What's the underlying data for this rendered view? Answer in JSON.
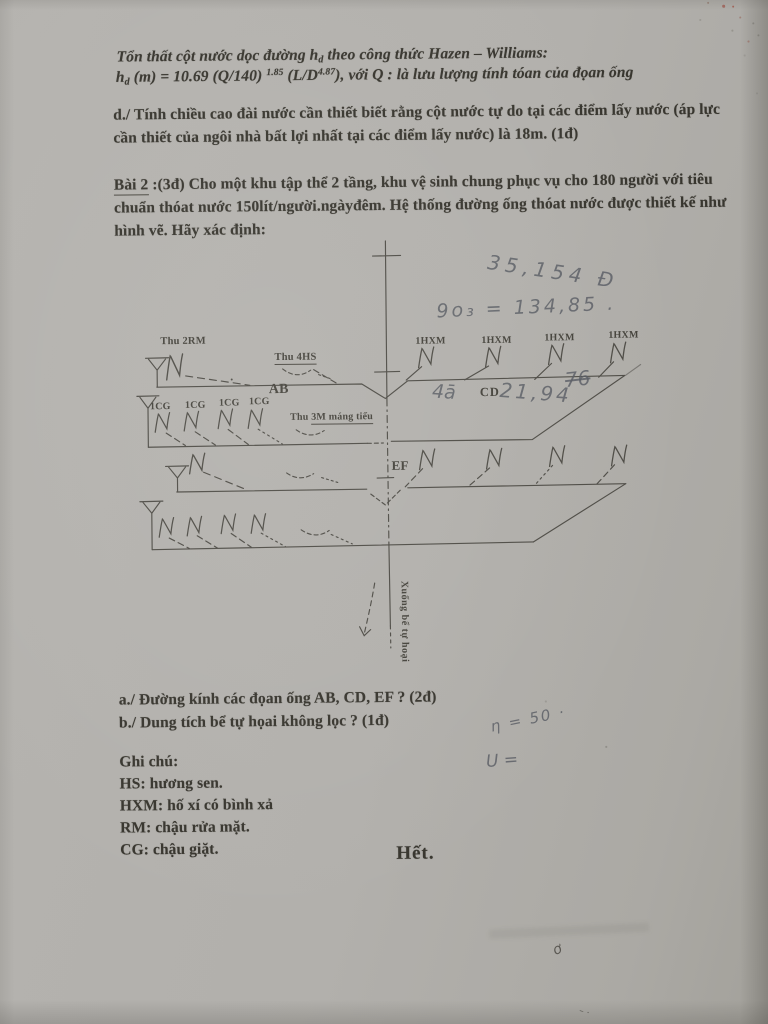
{
  "header": {
    "line1_pre": "Tổn thất cột nước dọc đường h",
    "line1_sub": "d",
    "line1_post": " theo công thức Hazen – Williams:",
    "formula_h": "h",
    "formula_sub": "d",
    "formula_mid1": " (m) =  10.69 (Q/140) ",
    "formula_exp1": "1.85",
    "formula_mid2": " (L/D",
    "formula_exp2": "4.87",
    "formula_post": "), với Q : là lưu lượng tính tóan của đọan ống"
  },
  "question_d": {
    "line1": "d./ Tính chiều cao đài nước cần thiết biết rằng cột nước tự do tại các điểm lấy nước (áp lực",
    "line2": "cần thiết của ngôi nhà bất lợi nhất tại các điểm lấy nước) là 18m. (1đ)"
  },
  "bai2": {
    "label": "Bài 2",
    "line1_rest": " :(3đ) Cho một khu tập thể 2 tầng, khu vệ sinh chung phục vụ cho 180 người với tiêu",
    "line2": "chuẩn thóat nước 150lít/người.ngàyđêm. Hệ thống đường ống thóat nước được thiết kế như",
    "line3": "hình vẽ. Hãy xác định:"
  },
  "diagram_labels": {
    "thu_2rm": "Thu 2RM",
    "thu_4hs": "Thu 4HS",
    "ab": "AB",
    "cd": "CD",
    "ef": "EF",
    "hxm": "1HXM",
    "cg": "1CG",
    "thu_3m_pre": "Thu ",
    "thu_3m_main": "3M máng tiểu",
    "xuong_be": "Xuống bể tự hoại"
  },
  "handwriting": {
    "total_top": "35,154 Đ",
    "q_value": "9o₃ = 134,85 .",
    "cd_left": "4ā",
    "cd_value": "21,94",
    "cd_struck": "76",
    "eta": "η = 50 ·",
    "u_mark": "U =",
    "o_scribble": "ơ",
    "bottom_mark": "– ·"
  },
  "questions": {
    "a": "a./ Đường kính các đọan ống AB, CD, EF ? (2đ)",
    "b": "b./ Dung tích bể tự họai không lọc ? (1đ)"
  },
  "notes": {
    "title": "Ghi chú:",
    "hs": "HS: hương sen.",
    "hxm": "HXM: hố xí có bình xả",
    "rm": "RM: chậu rửa mặt.",
    "cg": "CG: chậu giặt."
  },
  "footer": {
    "het": "Hết."
  },
  "colors": {
    "paper": "#b2b0ac",
    "ink": "#38362f",
    "diagram_line": "#4f4d47",
    "pencil": "#585c63",
    "red_speck": "#a14a3c"
  }
}
